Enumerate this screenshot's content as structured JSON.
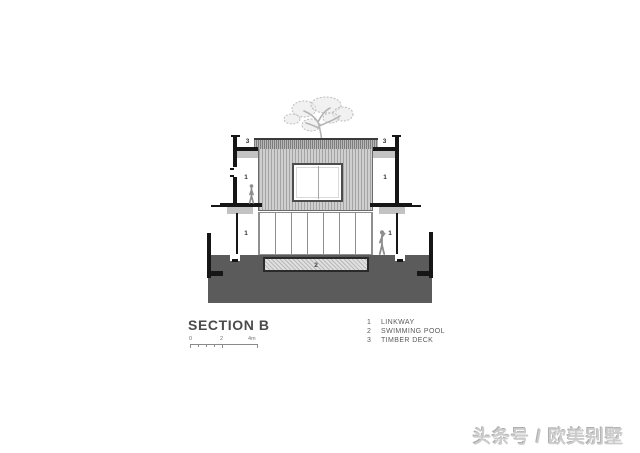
{
  "drawing": {
    "title": "SECTION B",
    "scale_bar": {
      "tick0": "0",
      "tick2": "2",
      "tick4": "4m"
    },
    "legend": {
      "items": [
        {
          "num": "1",
          "label": "LINKWAY"
        },
        {
          "num": "2",
          "label": "SWIMMING POOL"
        },
        {
          "num": "3",
          "label": "TIMBER DECK"
        }
      ]
    },
    "annotations": {
      "deck_left": "3",
      "deck_right": "3",
      "linkway_upper_left": "1",
      "linkway_upper_right": "1",
      "linkway_lower_left": "1",
      "linkway_lower_right": "1",
      "pool": "2"
    },
    "colors": {
      "ground": "#5b5b5b",
      "wall": "#161616",
      "cladding_fill": "#cfcfcf",
      "cladding_line": "#a4a4a4",
      "pool_fill": "#e0e0e0",
      "tree": "#c2c2c2",
      "figure": "#8d8d8d",
      "title_text": "#4b4b4b",
      "legend_text": "#5a5a5a",
      "watermark": "#cccccc"
    }
  },
  "watermark": {
    "text": "头条号 / 欧美别墅"
  }
}
